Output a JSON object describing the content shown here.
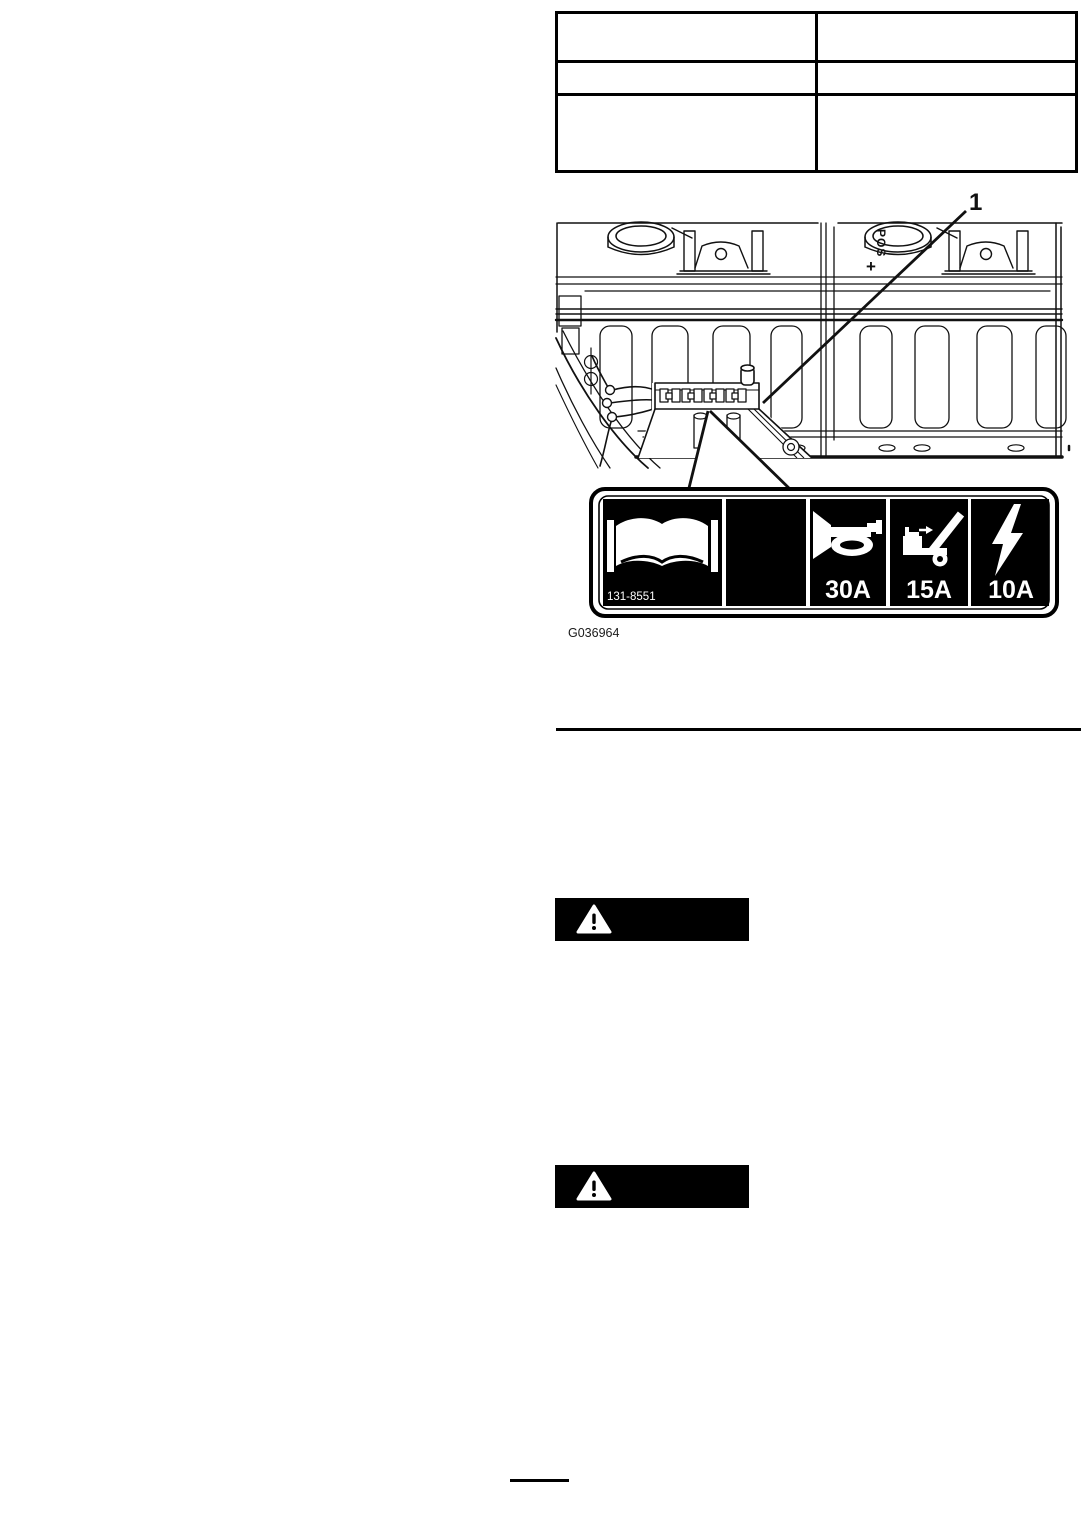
{
  "page": {
    "background": "#ffffff",
    "ink": "#000000"
  },
  "spec_table": {
    "columns": 2,
    "rows": [
      [
        "",
        ""
      ],
      [
        "",
        ""
      ],
      [
        "",
        ""
      ]
    ]
  },
  "figure": {
    "callout_1": "1",
    "battery_pos_label": "POS",
    "battery_pos_plus": "+",
    "caption": "G036964"
  },
  "decal": {
    "part_number": "131-8551",
    "background": "#000000",
    "foreground": "#ffffff",
    "cells": [
      {
        "icon": "operators-manual-book-icon",
        "label": ""
      },
      {
        "icon": "",
        "label": ""
      },
      {
        "icon": "horn-icon",
        "label": "30A"
      },
      {
        "icon": "dump-bed-raised-icon",
        "label": "15A"
      },
      {
        "icon": "electrical-power-icon",
        "label": "10A"
      }
    ]
  },
  "warnings": {
    "icon": "safety-alert-triangle-icon"
  }
}
